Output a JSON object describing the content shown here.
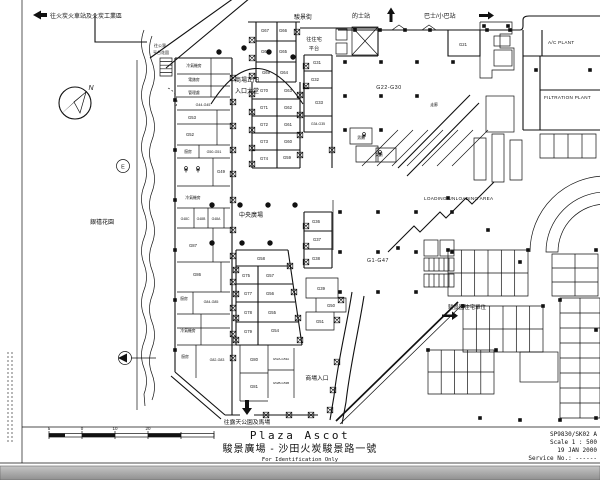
{
  "title_block": {
    "name_en": "Plaza Ascot",
    "name_zh": "駿景廣場 - 沙田火炭駿景路一號",
    "note": "For Identification Only",
    "drawing_no": "SP9830/SK02 A",
    "scale": "Scale 1 : 500",
    "date": "19 JAN 2000",
    "service_no": "Service No.: ------"
  },
  "annotations": {
    "to_fo_tan_station": "往火炭火車站及火炭工業區",
    "street_name": "駿景街",
    "taxi_stand": "的士站",
    "bus_stop": "巴士/小巴站",
    "to_public_podium_1": "往公眾",
    "to_public_podium_2": "平台花園",
    "to_residential_podium_1": "往住宅",
    "to_residential_podium_2": "平台",
    "main_entrance_1": "商場正門",
    "main_entrance_2": "入口大堂",
    "central_plaza": "中央廣場",
    "jubilee_garden": "銀禧花園",
    "loading_area": "LOADING/UNLOADING AREA",
    "ac_plant": "A/C PLANT",
    "filtration_plant": "FILTRATION PLANT",
    "residential_units": "駿景園住宅單位",
    "mall_entrance": "商場入口",
    "to_park_racecourse": "往露天公園及馬場",
    "corridor": "走廊",
    "grid_ref_e": "E",
    "north": "N"
  },
  "scale_bar": {
    "labels": [
      "5",
      "0",
      "10",
      "20"
    ]
  },
  "units": [
    {
      "id": "G67",
      "x": 265,
      "y": 32
    },
    {
      "id": "G66",
      "x": 283,
      "y": 32
    },
    {
      "id": "G68",
      "x": 265,
      "y": 53
    },
    {
      "id": "G65",
      "x": 283,
      "y": 53
    },
    {
      "id": "G69",
      "x": 266,
      "y": 74
    },
    {
      "id": "G64",
      "x": 284,
      "y": 74
    },
    {
      "id": "G70",
      "x": 264,
      "y": 92
    },
    {
      "id": "G63",
      "x": 288,
      "y": 92
    },
    {
      "id": "G71",
      "x": 264,
      "y": 109
    },
    {
      "id": "G62",
      "x": 288,
      "y": 109
    },
    {
      "id": "G72",
      "x": 264,
      "y": 126
    },
    {
      "id": "G61",
      "x": 288,
      "y": 126
    },
    {
      "id": "G73",
      "x": 264,
      "y": 143
    },
    {
      "id": "G60",
      "x": 288,
      "y": 143
    },
    {
      "id": "G74",
      "x": 264,
      "y": 160
    },
    {
      "id": "G59",
      "x": 287,
      "y": 159
    },
    {
      "id": "G21",
      "x": 463,
      "y": 46
    },
    {
      "id": "G31",
      "x": 317,
      "y": 64
    },
    {
      "id": "G32",
      "x": 315,
      "y": 81
    },
    {
      "id": "G33",
      "x": 319,
      "y": 104
    },
    {
      "id": "G34-G35",
      "x": 318,
      "y": 125,
      "s": 3.4
    },
    {
      "id": "G44-G45",
      "x": 203,
      "y": 106,
      "s": 3.6
    },
    {
      "id": "G53",
      "x": 192,
      "y": 119
    },
    {
      "id": "G52",
      "x": 190,
      "y": 136
    },
    {
      "id": "G50-G51",
      "x": 214,
      "y": 153,
      "s": 3.6
    },
    {
      "id": "G49",
      "x": 221,
      "y": 173
    },
    {
      "id": "G48C",
      "x": 185,
      "y": 220,
      "s": 3.4
    },
    {
      "id": "G48B",
      "x": 201,
      "y": 220,
      "s": 3.4
    },
    {
      "id": "G48A",
      "x": 216,
      "y": 220,
      "s": 3.4
    },
    {
      "id": "G87",
      "x": 193,
      "y": 247
    },
    {
      "id": "G86",
      "x": 197,
      "y": 276
    },
    {
      "id": "G84-G85",
      "x": 211,
      "y": 303,
      "s": 3.6
    },
    {
      "id": "G82-G83",
      "x": 217,
      "y": 361,
      "s": 3.6
    },
    {
      "id": "G58",
      "x": 261,
      "y": 260
    },
    {
      "id": "G75",
      "x": 246,
      "y": 277
    },
    {
      "id": "G57",
      "x": 270,
      "y": 277
    },
    {
      "id": "G77",
      "x": 248,
      "y": 295
    },
    {
      "id": "G56",
      "x": 270,
      "y": 295
    },
    {
      "id": "G78",
      "x": 248,
      "y": 314
    },
    {
      "id": "G55",
      "x": 272,
      "y": 314
    },
    {
      "id": "G79",
      "x": 248,
      "y": 333
    },
    {
      "id": "G54",
      "x": 275,
      "y": 332
    },
    {
      "id": "G36",
      "x": 316,
      "y": 223
    },
    {
      "id": "G37",
      "x": 317,
      "y": 241
    },
    {
      "id": "G38",
      "x": 316,
      "y": 260
    },
    {
      "id": "G39",
      "x": 321,
      "y": 290
    },
    {
      "id": "G50",
      "x": 331,
      "y": 307
    },
    {
      "id": "G51",
      "x": 320,
      "y": 323
    },
    {
      "id": "G80",
      "x": 254,
      "y": 361
    },
    {
      "id": "G81",
      "x": 254,
      "y": 388
    },
    {
      "id": "G52A-G53A",
      "x": 281,
      "y": 360,
      "s": 3
    },
    {
      "id": "G52B-G53B",
      "x": 281,
      "y": 384,
      "s": 3
    },
    {
      "id": "G22-G30",
      "x": 389,
      "y": 89,
      "big": true
    },
    {
      "id": "G1-G47",
      "x": 378,
      "y": 262,
      "big": true
    }
  ],
  "rooms": [
    {
      "label": "冷氣機房",
      "x": 194,
      "y": 67
    },
    {
      "label": "電錶房",
      "x": 194,
      "y": 81
    },
    {
      "label": "管理處",
      "x": 194,
      "y": 94
    },
    {
      "label": "廚房",
      "x": 188,
      "y": 153
    },
    {
      "label": "冷氣機房",
      "x": 193,
      "y": 199
    },
    {
      "label": "廚房",
      "x": 184,
      "y": 300
    },
    {
      "label": "冷氣機房",
      "x": 188,
      "y": 332
    },
    {
      "label": "廚房",
      "x": 185,
      "y": 358
    },
    {
      "label": "男廁",
      "x": 361,
      "y": 139
    },
    {
      "label": "女廁",
      "x": 379,
      "y": 156
    },
    {
      "label": "走廊",
      "x": 434,
      "y": 106
    }
  ]
}
